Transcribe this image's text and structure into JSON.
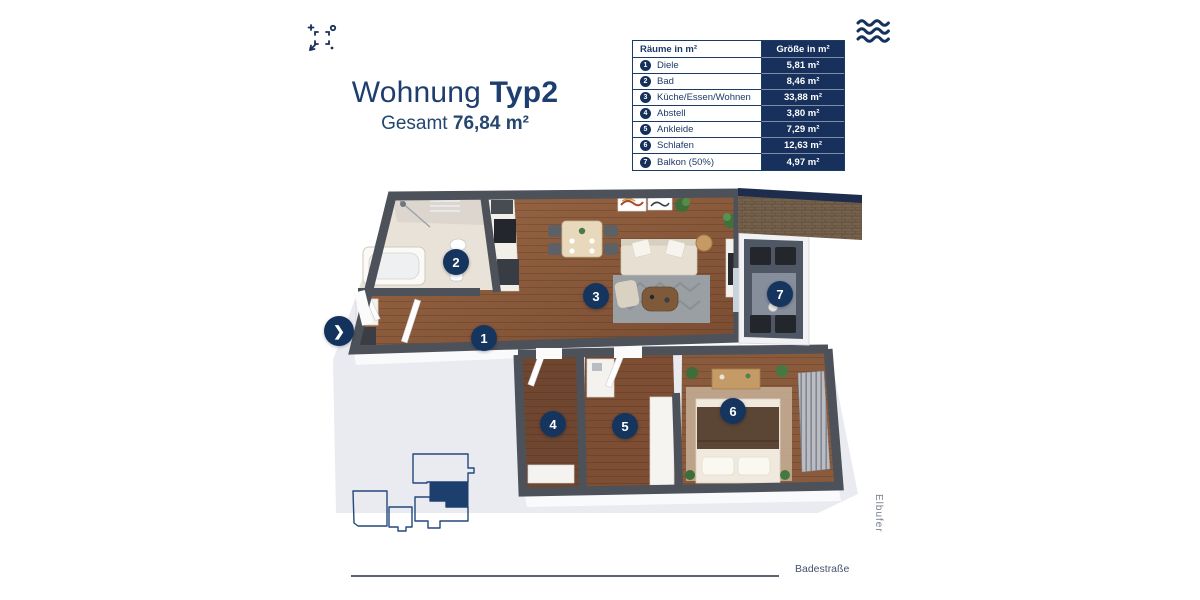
{
  "title": {
    "product": "Wohnung",
    "variant": "Typ2",
    "total_label": "Gesamt",
    "total_value": "76,84 m²"
  },
  "table": {
    "header": {
      "rooms": "Räume in m²",
      "size": "Größe in m²"
    },
    "rows": [
      {
        "number": "1",
        "name": "Diele",
        "size": "5,81 m²"
      },
      {
        "number": "2",
        "name": "Bad",
        "size": "8,46 m²"
      },
      {
        "number": "3",
        "name": "Küche/Essen/Wohnen",
        "size": "33,88 m²"
      },
      {
        "number": "4",
        "name": "Abstell",
        "size": "3,80 m²"
      },
      {
        "number": "5",
        "name": "Ankleide",
        "size": "7,29 m²"
      },
      {
        "number": "6",
        "name": "Schlafen",
        "size": "12,63 m²"
      },
      {
        "number": "7",
        "name": "Balkon (50%)",
        "size": "4,97 m²"
      }
    ]
  },
  "nav": {
    "next_arrow": "❯"
  },
  "map_labels": {
    "street_bottom": "Badestraße",
    "street_right": "Elbufer"
  },
  "icons": {
    "fullscreen": "fullscreen-expand-icon",
    "waves": "water-waves-icon",
    "next": "chevron-right-icon"
  },
  "colors": {
    "navy": "#17305c",
    "title_navy": "#1d3e6e",
    "wall_gray": "#4d525a",
    "wood": "#8a5a3c",
    "ground": "#e9ebf1",
    "highlight_unit": "#1d3f6e"
  }
}
